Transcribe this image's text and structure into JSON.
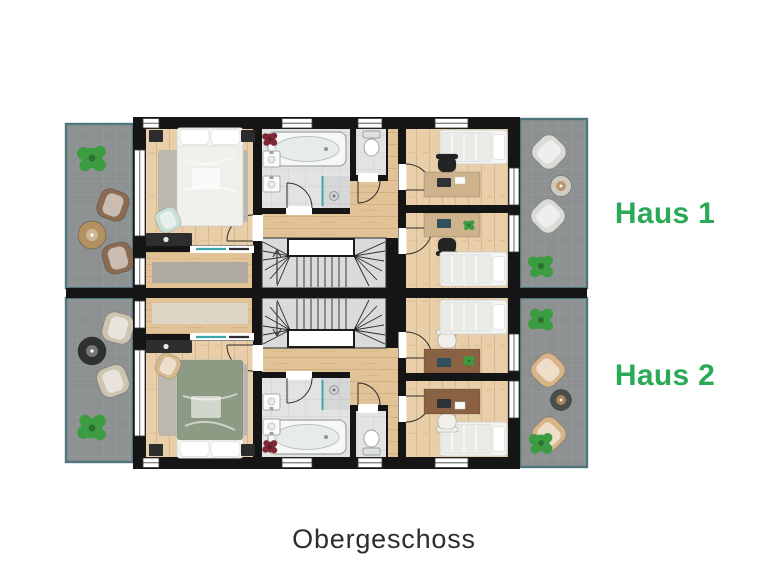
{
  "floor_label": "Obergeschoss",
  "units": [
    {
      "label": "Haus 1"
    },
    {
      "label": "Haus 2"
    }
  ],
  "icons": [
    "plant-icon",
    "armchair-icon",
    "side-table-icon",
    "double-bed-icon",
    "single-bed-icon",
    "desk-icon",
    "office-chair-icon",
    "bathtub-icon",
    "washbasin-icon",
    "toilet-icon",
    "shower-icon",
    "staircase-icon",
    "door-arc-icon",
    "window-icon",
    "wardrobe-icon",
    "rug-icon"
  ],
  "colors": {
    "accent": "#2aaa56",
    "label_dark": "#2c2c31",
    "wall": "#151515",
    "wood": "#e9cfa9",
    "hall_wood": "#e2c398",
    "tile": "#e1e4e3",
    "terrace": "#8e9192",
    "terrace_border": "#4e767c",
    "stair": "#d9dadb",
    "rug": "#b8b6b0",
    "glass": "#3fa7ac",
    "plant": "#3c9c42",
    "bath_plant": "#7e2836",
    "wardrobe": "#2e2e2e",
    "master_bed_h1": "#efefec",
    "master_bed_h2": "#8e9b84",
    "desk_h1": "#cdb28c",
    "desk_h2": "#8a6243",
    "desk_chair_h1": "#242424",
    "desk_chair_h2": "#f0efeb",
    "terrace_chair_left_h1": "#8a6a50",
    "terrace_chair_left_h2": "#cdc3b1",
    "terrace_chair_right_h1": "#dadad6",
    "terrace_chair_right_h2": "#d9b488",
    "terrace_table_left_h1": "#b3905f",
    "terrace_table_left_h2": "#2f3030",
    "terrace_table_right_h1": "#cfcac2",
    "terrace_table_right_h2": "#4a4d4e",
    "bed_chair_h1": "#c9ded4",
    "bed_chair_h2": "#d6b88e",
    "runner_h1": "#a8a7a2",
    "runner_h2": "#ddd8cb"
  }
}
